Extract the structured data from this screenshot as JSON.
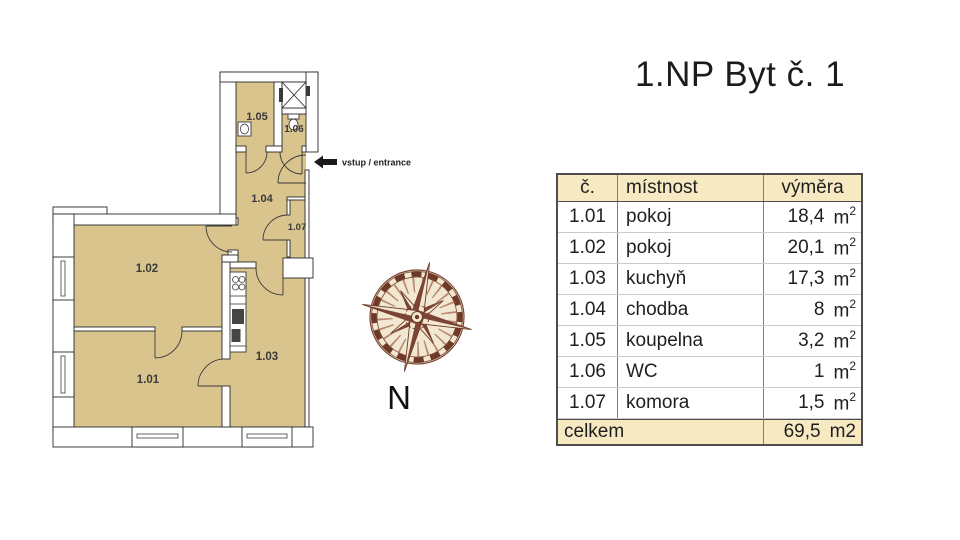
{
  "title": "1.NP Byt č. 1",
  "plan": {
    "labels": {
      "r101": "1.01",
      "r102": "1.02",
      "r103": "1.03",
      "r104": "1.04",
      "r105": "1.05",
      "r106": "1.06",
      "r107": "1.07"
    },
    "entrance_label": "vstup / entrance",
    "compass_label": "N"
  },
  "table": {
    "headers": {
      "num": "č.",
      "room": "místnost",
      "area": "výměra"
    },
    "rows": [
      {
        "num": "1.01",
        "room": "pokoj",
        "area": "18,4",
        "unit": "m",
        "exp": "2"
      },
      {
        "num": "1.02",
        "room": "pokoj",
        "area": "20,1",
        "unit": "m",
        "exp": "2"
      },
      {
        "num": "1.03",
        "room": "kuchyň",
        "area": "17,3",
        "unit": "m",
        "exp": "2"
      },
      {
        "num": "1.04",
        "room": "chodba",
        "area": "8",
        "unit": "m",
        "exp": "2"
      },
      {
        "num": "1.05",
        "room": "koupelna",
        "area": "3,2",
        "unit": "m",
        "exp": "2"
      },
      {
        "num": "1.06",
        "room": "WC",
        "area": "1",
        "unit": "m",
        "exp": "2"
      },
      {
        "num": "1.07",
        "room": "komora",
        "area": "1,5",
        "unit": "m",
        "exp": "2"
      }
    ],
    "footer": {
      "label": "celkem",
      "area": "69,5",
      "unit": "m2"
    }
  },
  "colors": {
    "room_fill": "#d9c48e",
    "table_band": "#f7e9c2",
    "wall_outline": "#2b2b2b",
    "compass_brown": "#6d3a28",
    "compass_cream": "#f2e8d2"
  }
}
